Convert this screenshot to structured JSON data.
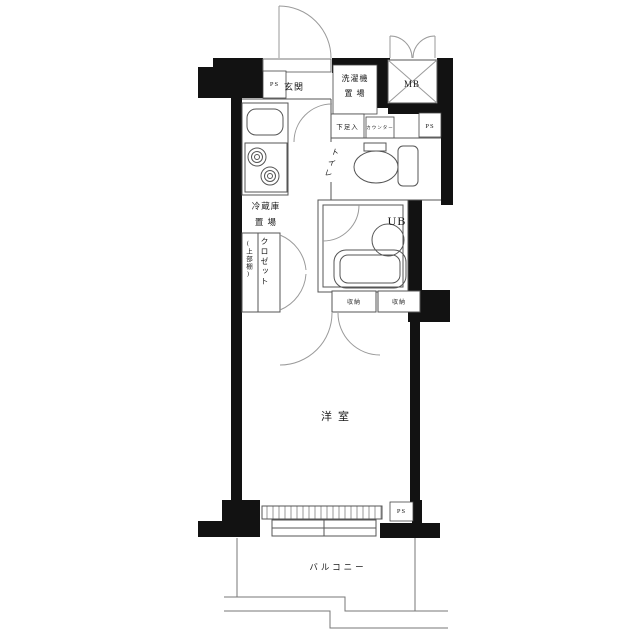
{
  "colors": {
    "wall": "#121212",
    "line": "#555555",
    "arc": "#9a9a9a",
    "background": "#ffffff"
  },
  "labels": {
    "entrance": "玄関",
    "washer": "洗濯機\n置 場",
    "meter_box": "MB",
    "pipe_space": "PS",
    "shoe_box": "下足入",
    "counter": "カウンター",
    "toilet": "トイレ",
    "unit_bath": "UB",
    "refrigerator": "冷蔵庫\n置 場",
    "closet": "クロゼット",
    "closet_note": "(上部棚)",
    "storage": "収納",
    "western_room": "洋室",
    "balcony": "バルコニー"
  }
}
